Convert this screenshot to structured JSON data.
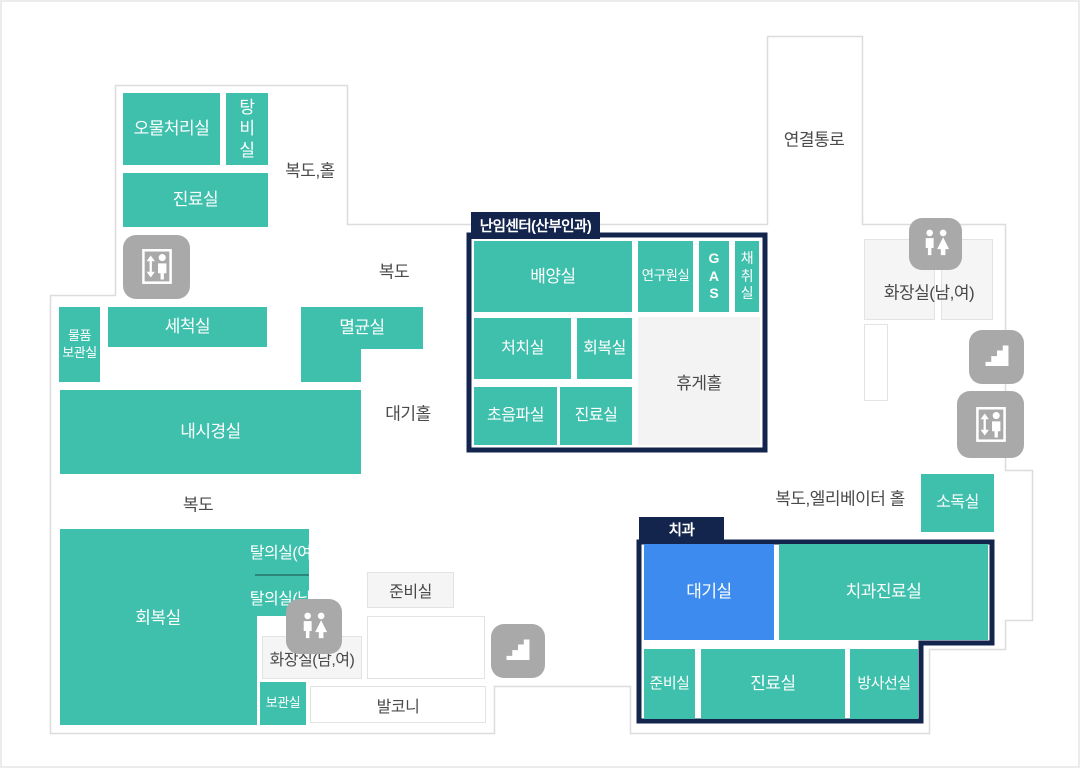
{
  "colors": {
    "room_teal": "#3ec0ad",
    "dental_waiting_blue": "#3d8bee",
    "section_navy": "#13254d",
    "icon_gray": "#a9a9a9",
    "wall_gray": "#dcdcdc"
  },
  "corridors": {
    "hall_top": "복도,홀",
    "corridor_top": "복도",
    "connecting_passage": "연결통로",
    "restroom_top": "화장실(남,여)",
    "waiting_hall": "대기홀",
    "corridor_left": "복도",
    "elevator_hall": "복도,엘리베이터 홀",
    "prep_room": "준비실",
    "restroom_bottom": "화장실(남,여)",
    "balcony": "발코니"
  },
  "rooms": {
    "waste_disposal": "오물처리실",
    "pantry": "탕\n비\n실",
    "clinic_top_left": "진료실",
    "goods_storage": "물품\n보관실",
    "washing": "세척실",
    "sterilization": "멸균실",
    "endoscopy": "내시경실",
    "recovery": "회복실",
    "changing_women": "탈의실(여)",
    "changing_men": "탈의실(남)",
    "storage": "보관실",
    "disinfection": "소독실"
  },
  "fertility_center": {
    "tab": "난임센터(산부인과)",
    "culture": "배양실",
    "researcher": "연구원실",
    "gas": "G\nA\nS",
    "collection": "채\n취\n실",
    "treatment": "처치실",
    "recovery": "회복실",
    "lounge": "휴게홀",
    "ultrasound": "초음파실",
    "clinic": "진료실"
  },
  "dental": {
    "tab": "치과",
    "waiting": "대기실",
    "dental_clinic": "치과진료실",
    "prep": "준비실",
    "clinic": "진료실",
    "radiology": "방사선실"
  }
}
